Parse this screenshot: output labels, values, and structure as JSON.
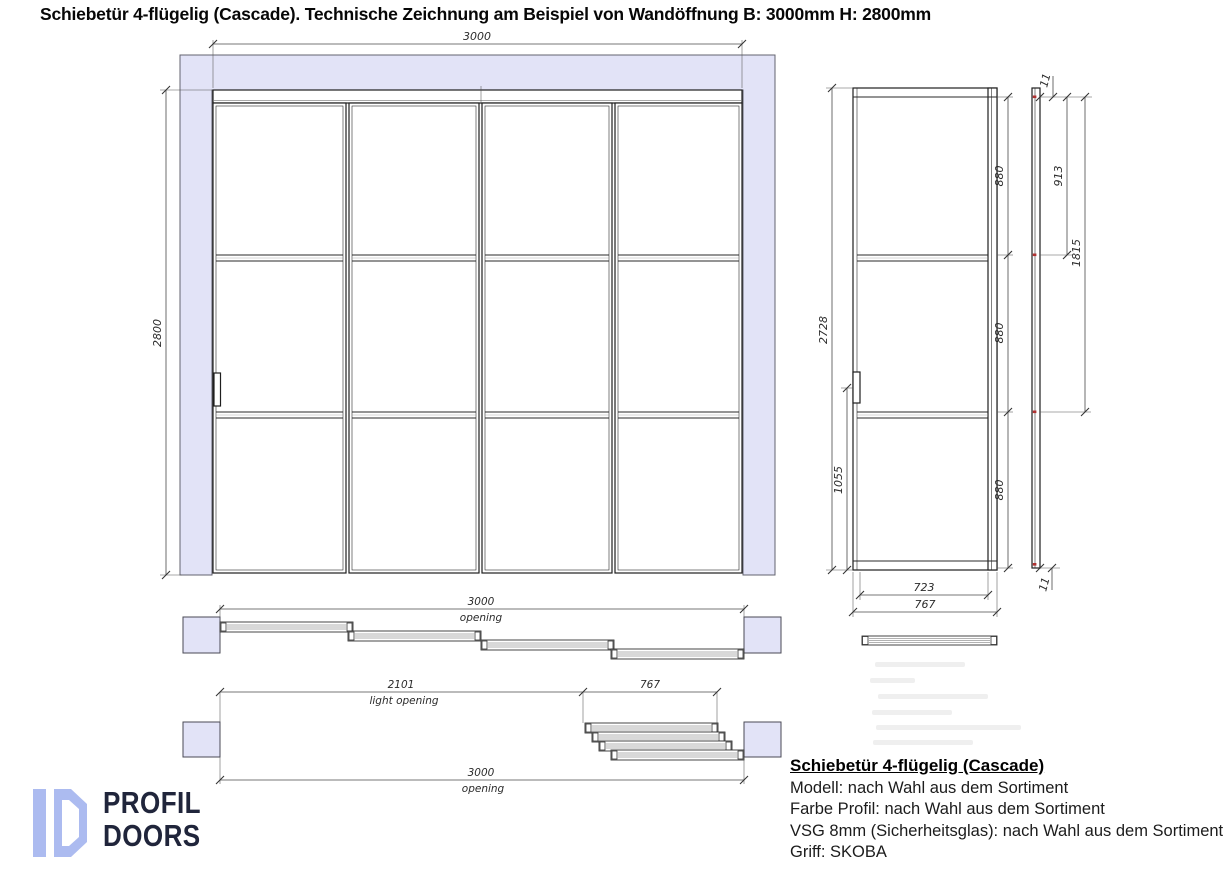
{
  "title": "Schiebetür 4-flügelig (Cascade). Technische Zeichnung am Beispiel von Wandöffnung B: 3000mm H: 2800mm",
  "front_view": {
    "width": "3000",
    "height": "2800"
  },
  "panel_view": {
    "height": "2728",
    "handle_offset": "1055",
    "rows": [
      "880",
      "880",
      "880"
    ],
    "inner_width": "723",
    "outer_width": "767"
  },
  "edge_view": {
    "top_offset": "11",
    "upper_span": "913",
    "lower_span": "1815",
    "bottom_offset": "11"
  },
  "plan_closed": {
    "width": "3000",
    "width_label": "opening"
  },
  "plan_open": {
    "light_width": "2101",
    "light_label": "light opening",
    "stack_width": "767",
    "width": "3000",
    "width_label": "opening"
  },
  "logo": {
    "line1": "PROFIL",
    "line2": "DOORS"
  },
  "specs": {
    "heading": "Schiebetür 4-flügelig (Cascade)",
    "lines": [
      "Modell: nach Wahl aus dem Sortiment",
      "Farbe Profil: nach Wahl aus dem Sortiment",
      "VSG 8mm (Sicherheitsglas): nach Wahl aus dem Sortiment",
      "Griff: SKOBA"
    ]
  },
  "colors": {
    "wall": "#e2e3f7",
    "line_dark": "#222222",
    "dim": "#444444",
    "red_mark": "#b03030",
    "logo_blue": "#acbbf0",
    "logo_navy": "#20253b"
  }
}
